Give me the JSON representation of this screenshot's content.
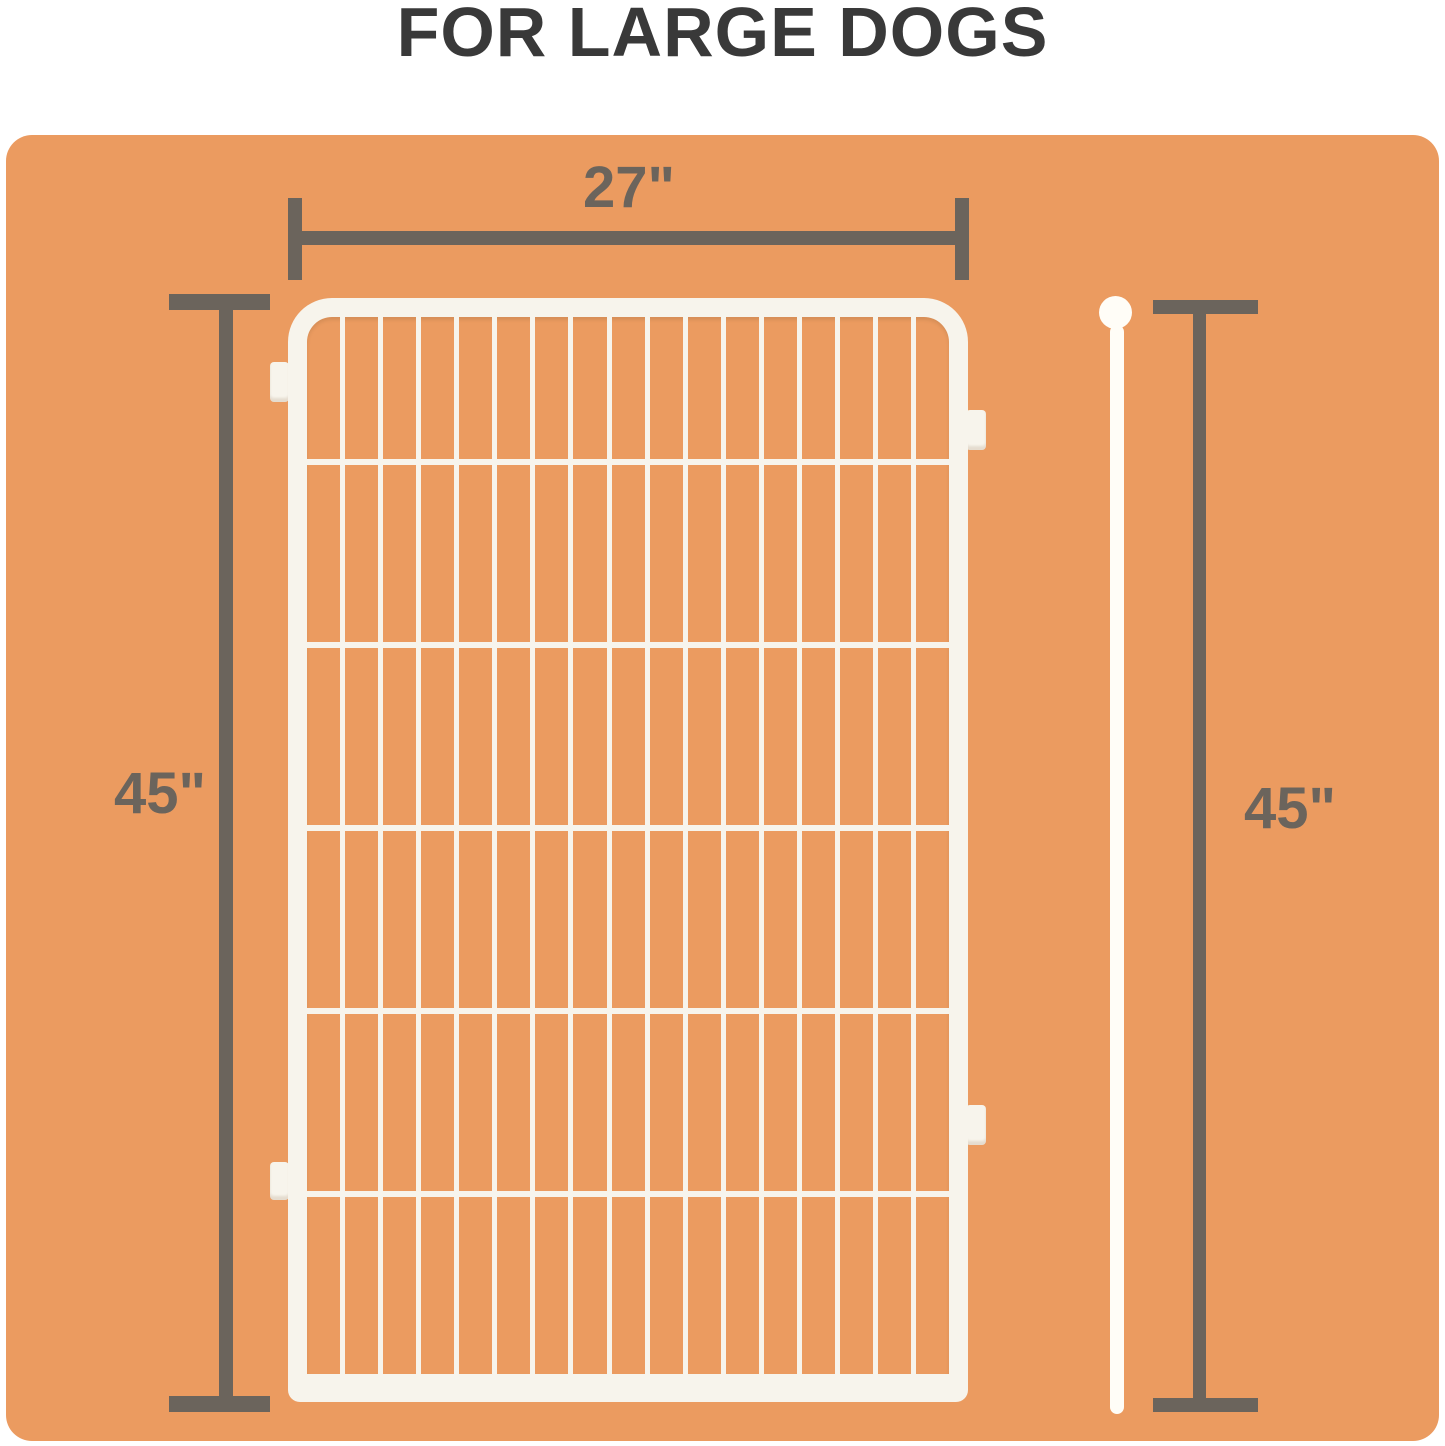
{
  "title": "FOR LARGE DOGS",
  "dimensions": {
    "width_label": "27\"",
    "height_left_label": "45\"",
    "height_right_label": "45\""
  },
  "fence": {
    "columns": 17,
    "rows": 6
  },
  "colors": {
    "background": "#ffffff",
    "panel_orange": "#EB9B60",
    "dimension_gray": "#6B645C",
    "title_gray": "#393939",
    "fence_white": "#F7F4EC"
  }
}
